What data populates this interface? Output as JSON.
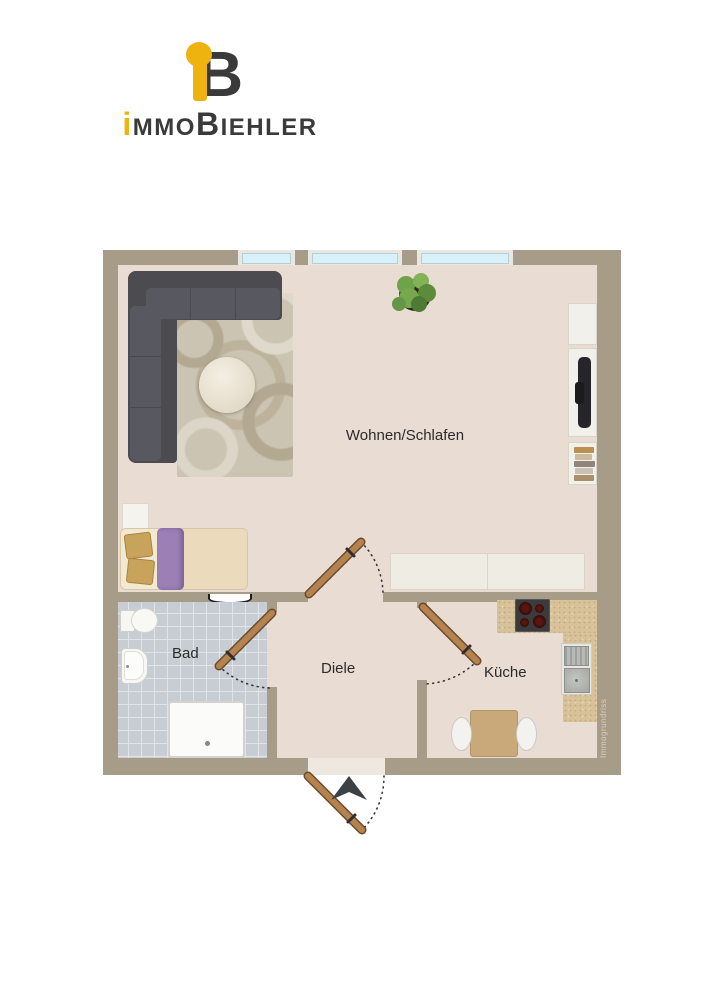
{
  "brand": {
    "monogram_b": "B",
    "word_i": "i",
    "word_mmo": "MMO",
    "word_b": "B",
    "word_iehler": "IEHLER",
    "accent_color": "#EFB310",
    "dark_color": "#3A3A3A"
  },
  "floorplan": {
    "labels": {
      "wohnen": "Wohnen/Schlafen",
      "bad": "Bad",
      "diele": "Diele",
      "kueche": "Küche"
    },
    "watermark": "Immogrundriss",
    "rooms": [
      {
        "id": "wohnen",
        "label": "Wohnen/Schlafen"
      },
      {
        "id": "bad",
        "label": "Bad"
      },
      {
        "id": "diele",
        "label": "Diele"
      },
      {
        "id": "kueche",
        "label": "Küche"
      }
    ],
    "colors": {
      "wall": "#A69C87",
      "floor": "#E8DCD3",
      "bath_tile": "#C7CDD2",
      "kitchen_counter": "#D8C29A",
      "door": "#B5834F",
      "window_glass": "#D6F1F8",
      "sofa": "#4B4B50",
      "bed_blanket": "#9B7FB5",
      "bed_mattress": "#EBDABC",
      "entry_arrow": "#3C4146"
    },
    "furniture": [
      "corner-sofa",
      "rug",
      "coffee-table",
      "plant",
      "tv-lowboard",
      "tv",
      "books",
      "sideboard",
      "bed",
      "nightstand",
      "radiator",
      "toilet",
      "washbasin",
      "shower",
      "cooktop",
      "kitchen-sink",
      "dining-table",
      "chairs"
    ]
  }
}
